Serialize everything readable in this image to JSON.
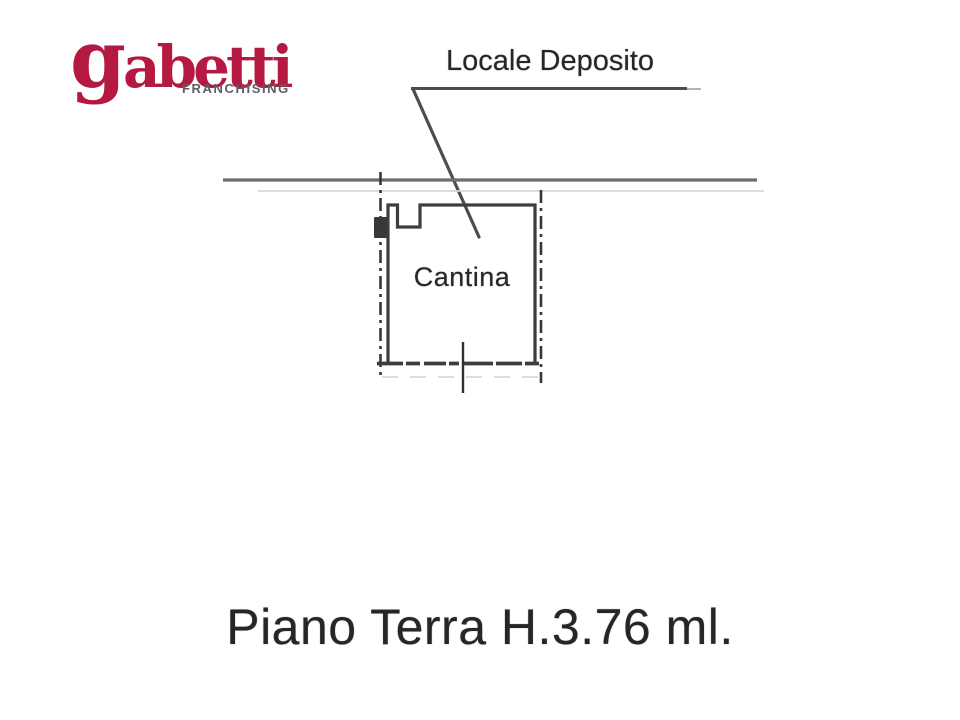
{
  "window": {
    "width": 960,
    "height": 720,
    "background": "#ffffff"
  },
  "logo": {
    "brand": "gabetti",
    "brand_initial": "g",
    "brand_rest": "abetti",
    "subtitle": "FRANCHISING",
    "brand_color": "#b51942",
    "subtitle_color": "#5b6065"
  },
  "plan": {
    "callout_label": "Locale Deposito",
    "room_label": "Cantina",
    "caption": "Piano Terra H.3.76 ml.",
    "text_color": "#262626",
    "wall_color": "#3d3d3d",
    "ground_line_color": "#6d6d6d",
    "leader_color": "#4d4d4d"
  }
}
